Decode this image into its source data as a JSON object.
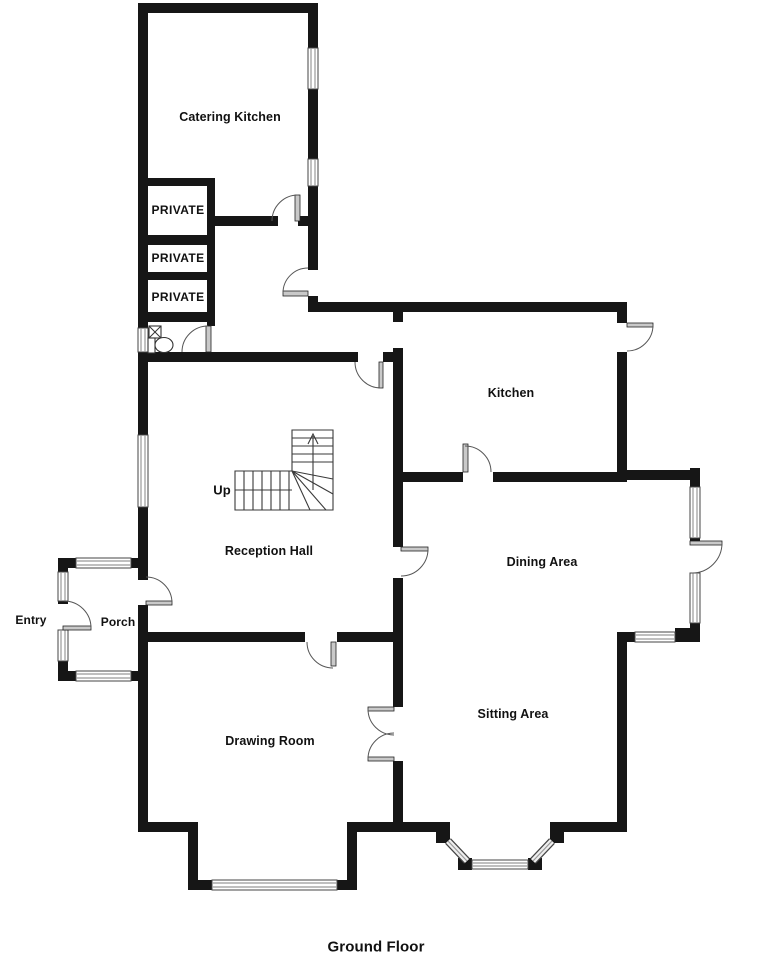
{
  "floor_title": "Ground Floor",
  "rooms": {
    "catering_kitchen": "Catering Kitchen",
    "private_1": "PRIVATE",
    "private_2": "PRIVATE",
    "private_3": "PRIVATE",
    "kitchen": "Kitchen",
    "reception_hall": "Reception Hall",
    "dining_area": "Dining Area",
    "sitting_area": "Sitting Area",
    "drawing_room": "Drawing Room",
    "porch": "Porch"
  },
  "annotations": {
    "entry_label": "Entry",
    "stairs_direction": "Up"
  },
  "fixtures": [
    "toilet",
    "corner-sink"
  ],
  "colors": {
    "wall": "#161616",
    "background": "#ffffff",
    "window_glass": "#999999",
    "door_leaf": "#c9c9c9"
  }
}
